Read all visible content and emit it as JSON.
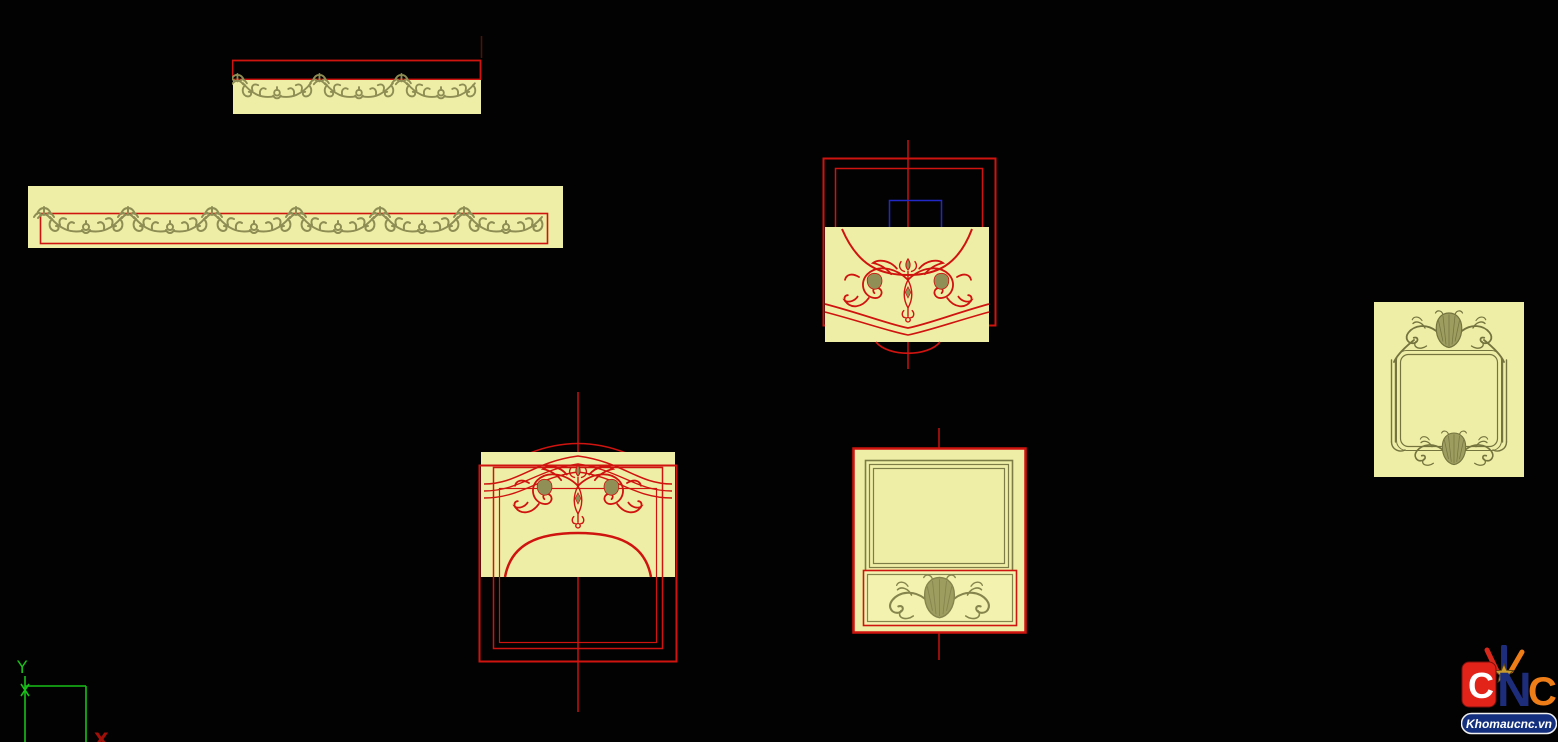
{
  "viewport": {
    "background": "#020202",
    "description": "black CAD drawing canvas with six carved-panel design previews"
  },
  "colors": {
    "background": "#020202",
    "panel_cream": "#EFEEA6",
    "panel_cream_light": "#F3F2AE",
    "ornament_olive": "#8D8D54",
    "ornament_olive_dark": "#74743F",
    "outline_red": "#CF1410",
    "centerline_red": "#C41210",
    "selection_blue": "#2228C8",
    "ucs_green": "#18C018",
    "ucs_x_red": "#A01008",
    "logo_red": "#E2231A",
    "logo_navy": "#1D2D7C",
    "logo_orange": "#EE7D18",
    "logo_banner_blue": "#142F7D",
    "logo_star_gold": "#C99B2E",
    "logo_text_white": "#FFFFFF"
  },
  "ucs": {
    "y_label": "Y",
    "x_label": "X"
  },
  "logo": {
    "letter_c1": "C",
    "letter_n": "N",
    "letter_c2": "C",
    "site": "Khomaucnc.vn"
  },
  "icons": {
    "ucs": "ucs-axis-icon",
    "logo_star": "star-icon",
    "logo_brushes": "brush-strokes-icon"
  }
}
